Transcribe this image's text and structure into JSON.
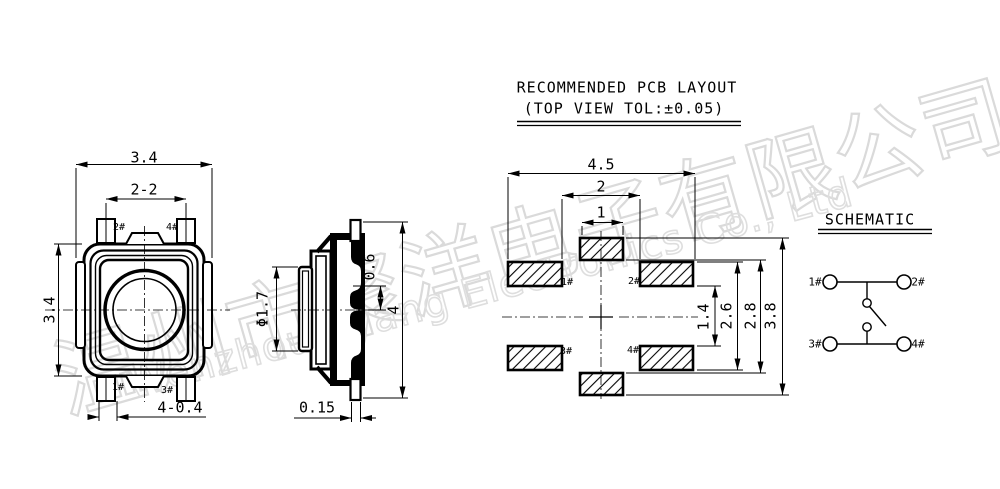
{
  "watermark": {
    "chinese": "温州市聚洋电子有限公司",
    "english": "Wenzhou Jiyang Electronics Co., Ltd"
  },
  "top_view": {
    "dim_width": "3.4",
    "dim_pin_span": "2-2",
    "dim_height": "3.4",
    "dim_pad": "4-0.4",
    "pin_top_left": "2#",
    "pin_top_right": "4#",
    "pin_bottom_left": "1#",
    "pin_bottom_right": "3#"
  },
  "side_view": {
    "dim_button_diameter": "Φ1.7",
    "dim_step": "0.6",
    "dim_height": "4",
    "dim_terminal_thickness": "0.15"
  },
  "pcb_layout": {
    "title": "RECOMMENDED PCB LAYOUT",
    "subtitle": "(TOP VIEW TOL:±0.05)",
    "dim_overall_width": "4.5",
    "dim_pad_inner_span": "2",
    "dim_center_pad_width": "1",
    "dim_side_pad_gap": "1.4",
    "dim_side_pad_span": "2.6",
    "dim_center_pad_gap": "2.8",
    "dim_overall_height": "3.8",
    "pad_1": "1#",
    "pad_2": "2#",
    "pad_3": "3#",
    "pad_4": "4#"
  },
  "schematic": {
    "title": "SCHEMATIC",
    "pin_1": "1#",
    "pin_2": "2#",
    "pin_3": "3#",
    "pin_4": "4#"
  },
  "colors": {
    "line": "#000000",
    "background": "#ffffff",
    "watermark": "#dadada"
  }
}
